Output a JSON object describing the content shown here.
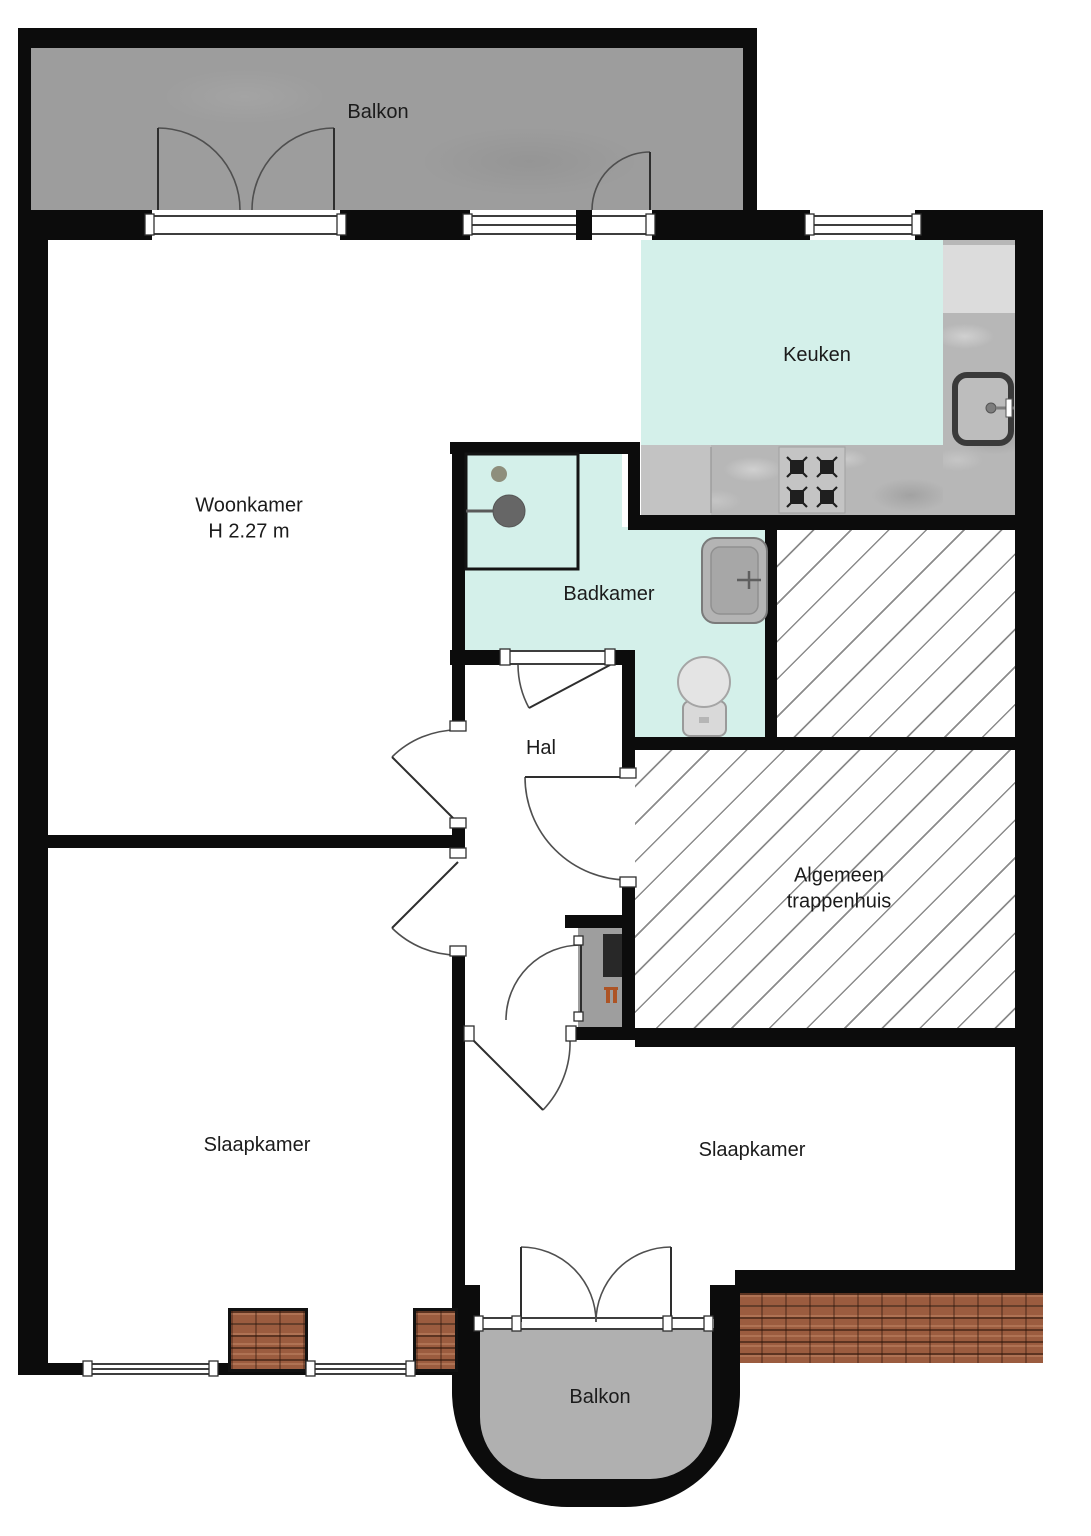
{
  "rooms": {
    "balcony_top": {
      "label": "Balkon"
    },
    "kitchen": {
      "label": "Keuken"
    },
    "living_room": {
      "label": "Woonkamer",
      "height_note": "H 2.27 m"
    },
    "bathroom": {
      "label": "Badkamer"
    },
    "hall": {
      "label": "Hal"
    },
    "stairwell": {
      "label_line1": "Algemeen",
      "label_line2": "trappenhuis"
    },
    "bedroom_left": {
      "label": "Slaapkamer"
    },
    "bedroom_right": {
      "label": "Slaapkamer"
    },
    "balcony_bottom": {
      "label": "Balkon"
    }
  },
  "fixtures": [
    "french-balcony-doors",
    "balcony-door",
    "kitchen-counter",
    "refrigerator-counter",
    "gas-stove-4-burners",
    "kitchen-sink",
    "shower",
    "washbasin",
    "toilet",
    "meter-cabinet",
    "electrical-panel",
    "radiator-symbol",
    "roof-tiles",
    "hatched-stairwell",
    "hatched-storage"
  ],
  "colors": {
    "wall": "#0c0c0c",
    "wet_floor": "#d4f0ea",
    "balcony_top": "#9d9d9d",
    "balcony_bottom": "#b0b0b0",
    "counter": "#b7b7b7",
    "appliance_light": "#dcdcdc",
    "roof_tile": "#9b5c3f",
    "hatch_line": "#8b8b8b",
    "door_arc": "#4f4f4f",
    "meter_accent": "#ad5425",
    "text": "#1b1b1b"
  }
}
